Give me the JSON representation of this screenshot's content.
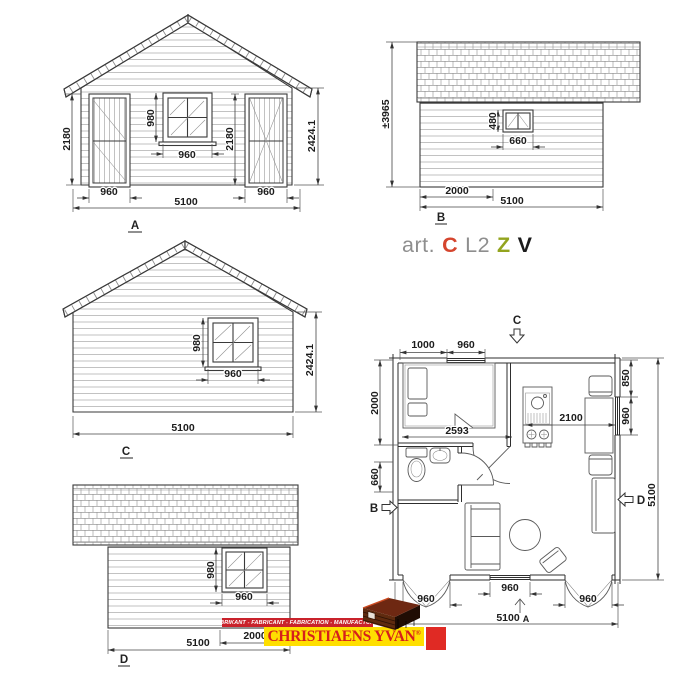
{
  "art_code": {
    "prefix": "art.",
    "c": "C",
    "l2": "L2",
    "z": "Z",
    "v": "V"
  },
  "colors": {
    "line": "#3a3a3a",
    "art_gray": "#8e8e8e",
    "art_red": "#d5452e",
    "art_green": "#93a41e",
    "art_black": "#1b1b1b",
    "logo_banner_red": "#c9222b",
    "logo_yellow": "#ffdf00",
    "logo_text_red": "#d6201c",
    "logo_square_red": "#e02a24"
  },
  "views": {
    "front": {
      "label": "A",
      "dims": {
        "height_left": "2180",
        "window_height": "980",
        "height_inner": "2180",
        "height_total": "2424.1",
        "window_width": "960",
        "door_left": "960",
        "width_total": "5100",
        "door_right": "960"
      }
    },
    "side_b": {
      "label": "B",
      "dims": {
        "height_total": "±3965",
        "window_height": "480",
        "window_width": "660",
        "offset": "2000",
        "width_total": "5100"
      }
    },
    "rear": {
      "label": "C",
      "dims": {
        "window_height": "980",
        "window_width": "960",
        "height_total": "2424.1",
        "width_total": "5100"
      }
    },
    "side_d": {
      "label": "D",
      "dims": {
        "window_height": "980",
        "window_width": "960",
        "offset": "2000",
        "width_total": "5100"
      }
    }
  },
  "floorplan": {
    "section_labels": {
      "a": "A",
      "b": "B",
      "c": "C",
      "d": "D"
    },
    "dims": {
      "top_offset": "1000",
      "top_window": "960",
      "bedroom_depth": "2000",
      "bath_door": "660",
      "bedroom_width": "2593",
      "living_width": "2100",
      "right_offset": "850",
      "right_window": "960",
      "side_total": "5100",
      "bottom_window": "960",
      "door_left": "960",
      "door_right": "960",
      "bottom_total": "5100"
    }
  },
  "logo": {
    "banner": "FABRIKANT - FABRICANT - FABRICATION - MANUFACTURER",
    "name": "CHRISTIAENS YVAN",
    "registered": "®"
  }
}
